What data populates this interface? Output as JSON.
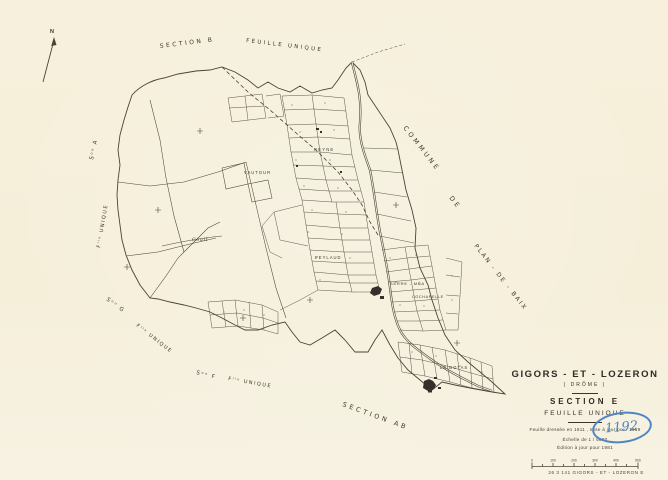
{
  "compass": {
    "north": "N"
  },
  "edge_labels": {
    "top_section": "SECTION B",
    "top_feuille": "FEUILLE UNIQUE",
    "left_section_a": "Sᵒⁿ A",
    "left_feuille_a": "Fˡˡᵉ UNIQUE",
    "left_section_g": "Sᵒⁿ G",
    "left_feuille_g": "Fˡˡᵉ UNIQUE",
    "left_section_f": "Sᵒⁿ F",
    "left_feuille_f": "Fˡˡᵉ UNIQUE",
    "bottom_section_ab": "SECTION AB",
    "right_commune": "COMMUNE",
    "right_de": "DE",
    "right_plan_de_baix": "PLAN - DE - BAIX"
  },
  "place_labels": {
    "reyne": "REYNE",
    "vautour": "VAUTOUR",
    "coult": "Coult",
    "peylaud": "PEYLAUD",
    "serre_mea": "SERRE - MÉA",
    "cocharelle": "COCHARELLE",
    "le_botas": "LE BOTAS"
  },
  "title_block": {
    "commune": "GIGORS - ET - LOZERON",
    "departement": "( DRÔME )",
    "section": "SECTION E",
    "feuille": "FEUILLE UNIQUE",
    "note_dressee": "Feuille dressée en 1811 , mise à jour pour 1959",
    "note_echelle": "Échelle de 1 / 5000",
    "note_edition": "Édition à jour pour 1981",
    "scale_bar_labels": [
      "0",
      "100",
      "200",
      "300",
      "400",
      "500"
    ],
    "reference": "26 3 141   GIGORS - ET - LOZERON   E"
  },
  "annotations": {
    "blue_number": "1192"
  },
  "colors": {
    "paper": "#f6f0dc",
    "ink": "#4a4337",
    "blue_ink": "#4e86c4"
  }
}
